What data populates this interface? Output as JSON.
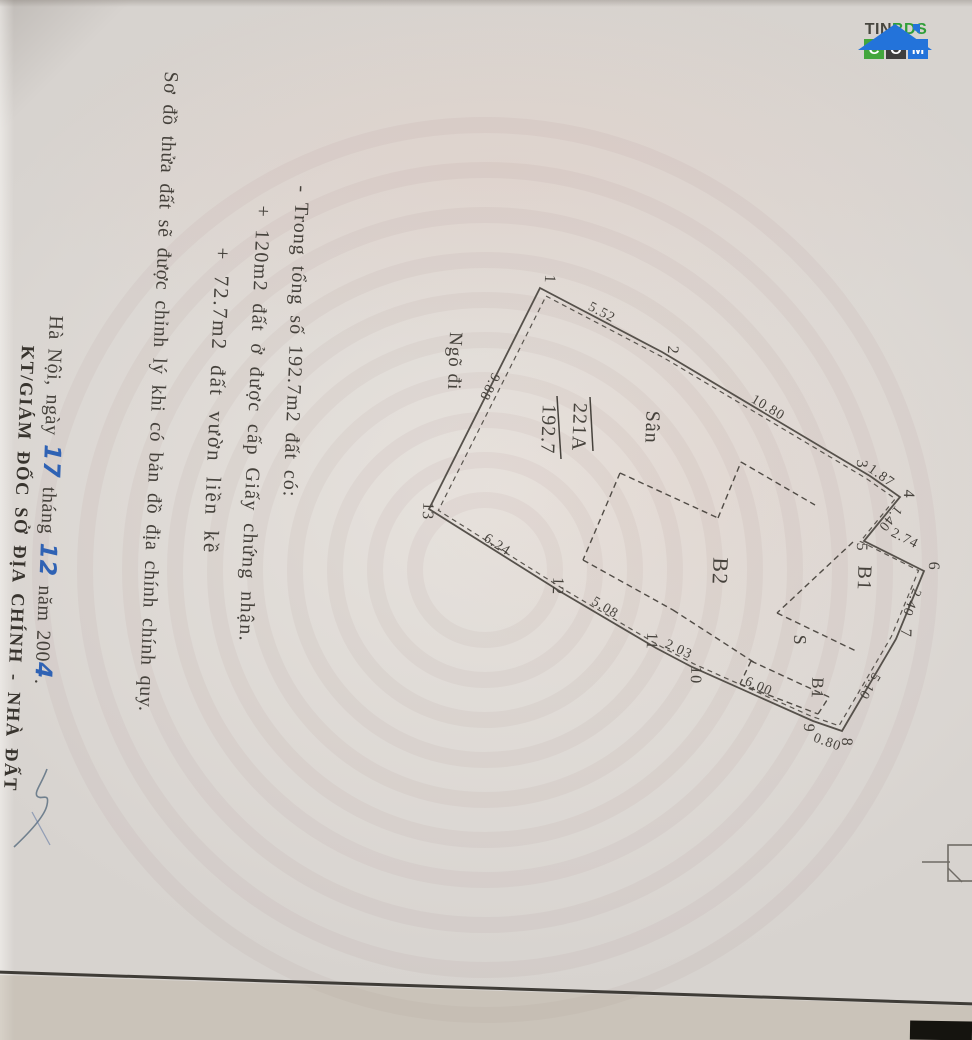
{
  "logo": {
    "tin": "TIN",
    "bds": "BDS",
    "c": "C",
    "o": "O",
    "m": "M"
  },
  "notes": {
    "line1": "- Trong tổng số 192.7m2 đất có:",
    "line2": "+ 120m2 đất ở được cấp Giấy chứng nhận.",
    "line3": "+ 72.7m2 đất vườn liền kề",
    "line4": "Sơ đồ thửa đất sẽ được chỉnh lý khi có bản đồ địa chính chính quy."
  },
  "signature": {
    "place_prefix": "Hà Nội, ngày ",
    "day": "17",
    "month_prefix": " tháng ",
    "month": "12",
    "year_prefix": " năm 200",
    "year_digit": "4",
    "period": ".",
    "title_line": "KT/GIÁM ĐỐC SỞ ĐỊA CHÍNH - NHÀ ĐẤT"
  },
  "diagram": {
    "parcel_number": "221A",
    "parcel_area": "192.7",
    "line_color": "#56514b",
    "text_color": "#46423c",
    "vertices": [
      {
        "n": "1",
        "x": 540,
        "y": 288,
        "lx": 545,
        "ly": 279
      },
      {
        "n": "2",
        "x": 662,
        "y": 352,
        "lx": 668,
        "ly": 350
      },
      {
        "n": "3",
        "x": 870,
        "y": 476,
        "lx": 857,
        "ly": 464
      },
      {
        "n": "4",
        "x": 900,
        "y": 497,
        "lx": 904,
        "ly": 494
      },
      {
        "n": "5",
        "x": 864,
        "y": 541,
        "lx": 857,
        "ly": 547
      },
      {
        "n": "6",
        "x": 924,
        "y": 571,
        "lx": 929,
        "ly": 566
      },
      {
        "n": "7",
        "x": 896,
        "y": 639,
        "lx": 901,
        "ly": 633
      },
      {
        "n": "8",
        "x": 842,
        "y": 731,
        "lx": 842,
        "ly": 742
      },
      {
        "n": "9",
        "x": 813,
        "y": 721,
        "lx": 804,
        "ly": 728
      },
      {
        "n": "10",
        "x": 692,
        "y": 667,
        "lx": 691,
        "ly": 675
      },
      {
        "n": "11",
        "x": 656,
        "y": 648,
        "lx": 647,
        "ly": 641
      },
      {
        "n": "12",
        "x": 561,
        "y": 592,
        "lx": 553,
        "ly": 586
      },
      {
        "n": "13",
        "x": 429,
        "y": 509,
        "lx": 423,
        "ly": 511
      }
    ],
    "edges": [
      {
        "from": "1",
        "to": "2",
        "len": "5.52",
        "lx": 600,
        "ly": 316,
        "rot": 28
      },
      {
        "from": "2",
        "to": "3",
        "len": "10.80",
        "lx": 766,
        "ly": 411,
        "rot": 31
      },
      {
        "from": "3",
        "to": "4",
        "len": "1.87",
        "lx": 879,
        "ly": 479,
        "rot": 35
      },
      {
        "from": "4",
        "to": "5",
        "len": "1.40",
        "lx": 887,
        "ly": 516,
        "rot": 129
      },
      {
        "from": "5",
        "to": "6",
        "len": "2.74",
        "lx": 903,
        "ly": 542,
        "rot": 27
      },
      {
        "from": "6",
        "to": "7",
        "len": "2.40",
        "lx": 908,
        "ly": 601,
        "rot": 112
      },
      {
        "from": "7",
        "to": "8",
        "len": "5.10",
        "lx": 866,
        "ly": 684,
        "rot": 121
      },
      {
        "from": "8",
        "to": "9",
        "len": "0.80",
        "lx": 826,
        "ly": 746,
        "rot": 20
      },
      {
        "from": "9",
        "to": "10",
        "len": "6.00",
        "lx": 757,
        "ly": 690,
        "rot": 24
      },
      {
        "from": "10",
        "to": "11",
        "len": "2.03",
        "lx": 677,
        "ly": 653,
        "rot": 25
      },
      {
        "from": "11",
        "to": "12",
        "len": "5.08",
        "lx": 603,
        "ly": 611,
        "rot": 31
      },
      {
        "from": "12",
        "to": "13",
        "len": "6.24",
        "lx": 495,
        "ly": 548,
        "rot": 33
      },
      {
        "from": "13",
        "to": "1",
        "len": "9.88",
        "lx": 486,
        "ly": 385,
        "rot": 117
      }
    ],
    "region_labels": [
      {
        "text": "Sân",
        "x": 646,
        "y": 427,
        "size": 20
      },
      {
        "text": "B2",
        "x": 713,
        "y": 571,
        "size": 22
      },
      {
        "text": "B1",
        "x": 858,
        "y": 578,
        "size": 20
      },
      {
        "text": "S",
        "x": 794,
        "y": 640,
        "size": 18
      },
      {
        "text": "B1",
        "x": 812,
        "y": 688,
        "size": 17
      },
      {
        "text": "Ngõ đi",
        "x": 449,
        "y": 361,
        "size": 19
      }
    ],
    "walls": [
      [
        620,
        473,
        718,
        518
      ],
      [
        718,
        518,
        741,
        462
      ],
      [
        741,
        462,
        815,
        505
      ],
      [
        853,
        542,
        777,
        613
      ],
      [
        777,
        613,
        856,
        651
      ],
      [
        751,
        661,
        829,
        697
      ],
      [
        751,
        661,
        740,
        684
      ],
      [
        740,
        684,
        818,
        714
      ],
      [
        818,
        714,
        829,
        697
      ],
      [
        620,
        473,
        583,
        560
      ],
      [
        583,
        560,
        673,
        610
      ],
      [
        673,
        610,
        755,
        663
      ]
    ],
    "fraction": {
      "num_x": 573,
      "num_y": 427,
      "den_x": 542,
      "den_y": 429,
      "rot": 92,
      "bar": [
        557,
        396,
        561,
        459
      ],
      "overline": [
        590,
        397,
        593,
        451
      ]
    }
  }
}
